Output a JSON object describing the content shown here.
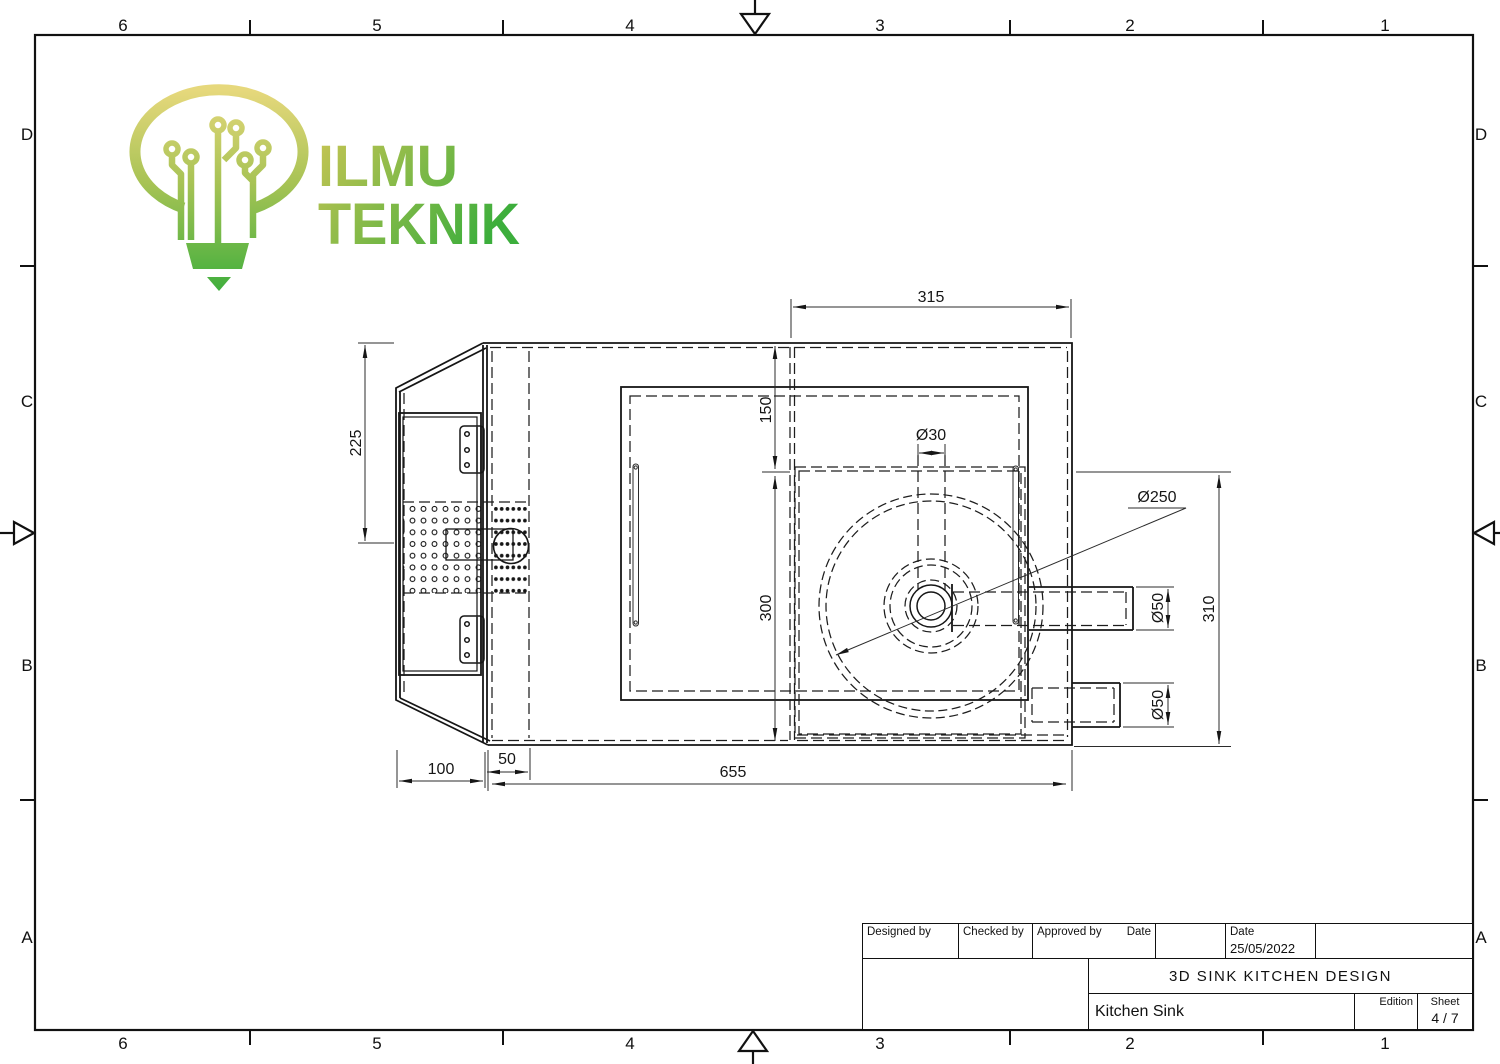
{
  "grid": {
    "columns": [
      "6",
      "5",
      "4",
      "3",
      "2",
      "1"
    ],
    "rows": [
      "D",
      "C",
      "B",
      "A"
    ]
  },
  "logo": {
    "word1": "ILMU",
    "word2": "TEKNIK"
  },
  "colors": {
    "logo_top": "#e6d87c",
    "logo_mid": "#a8c355",
    "logo_green": "#3cae3c",
    "text_top": "#c9c554",
    "line": "#161616"
  },
  "dimensions": {
    "top_width": "315",
    "left_height": "225",
    "upper_offset": "150",
    "bowl_depth": "300",
    "drain_hole": "Ø30",
    "bowl_dia": "Ø250",
    "outlet_upper": "Ø50",
    "outlet_lower": "Ø50",
    "right_height": "310",
    "door_width": "100",
    "strip_width": "50",
    "body_width": "655"
  },
  "title_block": {
    "designed_by": "Designed by",
    "checked_by": "Checked by",
    "approved_by": "Approved by",
    "date_label": "Date",
    "date_value": "25/05/2022",
    "project_title": "3D SINK KITCHEN DESIGN",
    "part_title": "Kitchen Sink",
    "edition_label": "Edition",
    "sheet_label": "Sheet",
    "sheet_value": "4 / 7"
  }
}
